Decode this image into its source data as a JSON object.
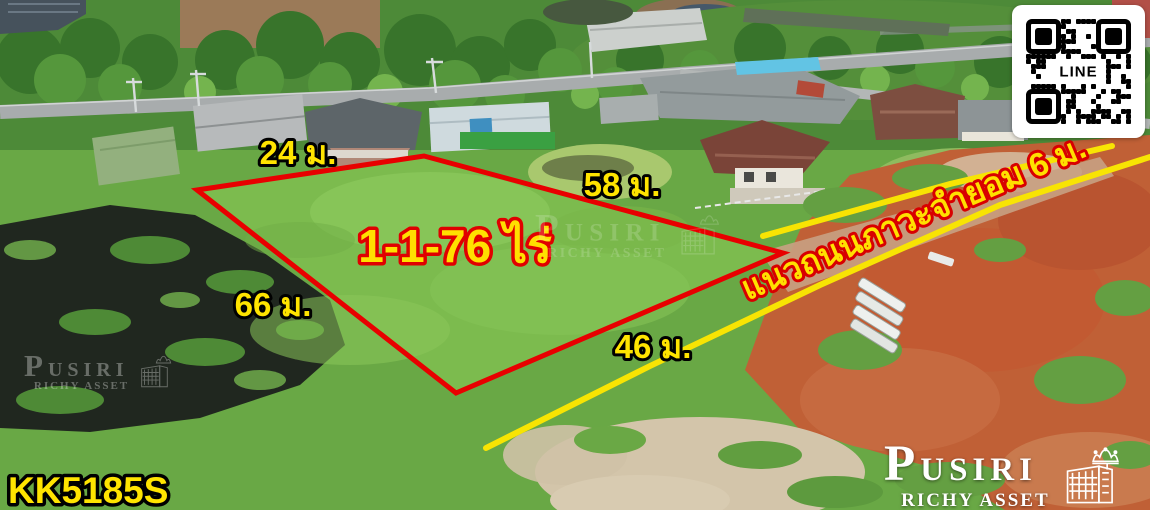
{
  "annotations": {
    "area_label": "1-1-76 ไร่",
    "dim_top": "24 ม.",
    "dim_upper_right": "58 ม.",
    "dim_left": "66 ม.",
    "dim_bottom": "46 ม.",
    "road_label": "แนวถนนภาวะจำยอม 6 ม.",
    "listing_code": "KK5185S"
  },
  "branding": {
    "logo_name": "PUSIRI",
    "logo_subtitle": "RICHY ASSET",
    "qr_label": "LINE"
  },
  "icons": {
    "qr": "line-qr-code",
    "logo_building": "building-icon",
    "logo_crown": "crown-icon"
  },
  "colors": {
    "plot_outline": "#e80000",
    "easement_line": "#f8e403",
    "label_yellow": "#ffe400",
    "label_red_outline": "#d80000",
    "label_black_outline": "#000000"
  }
}
